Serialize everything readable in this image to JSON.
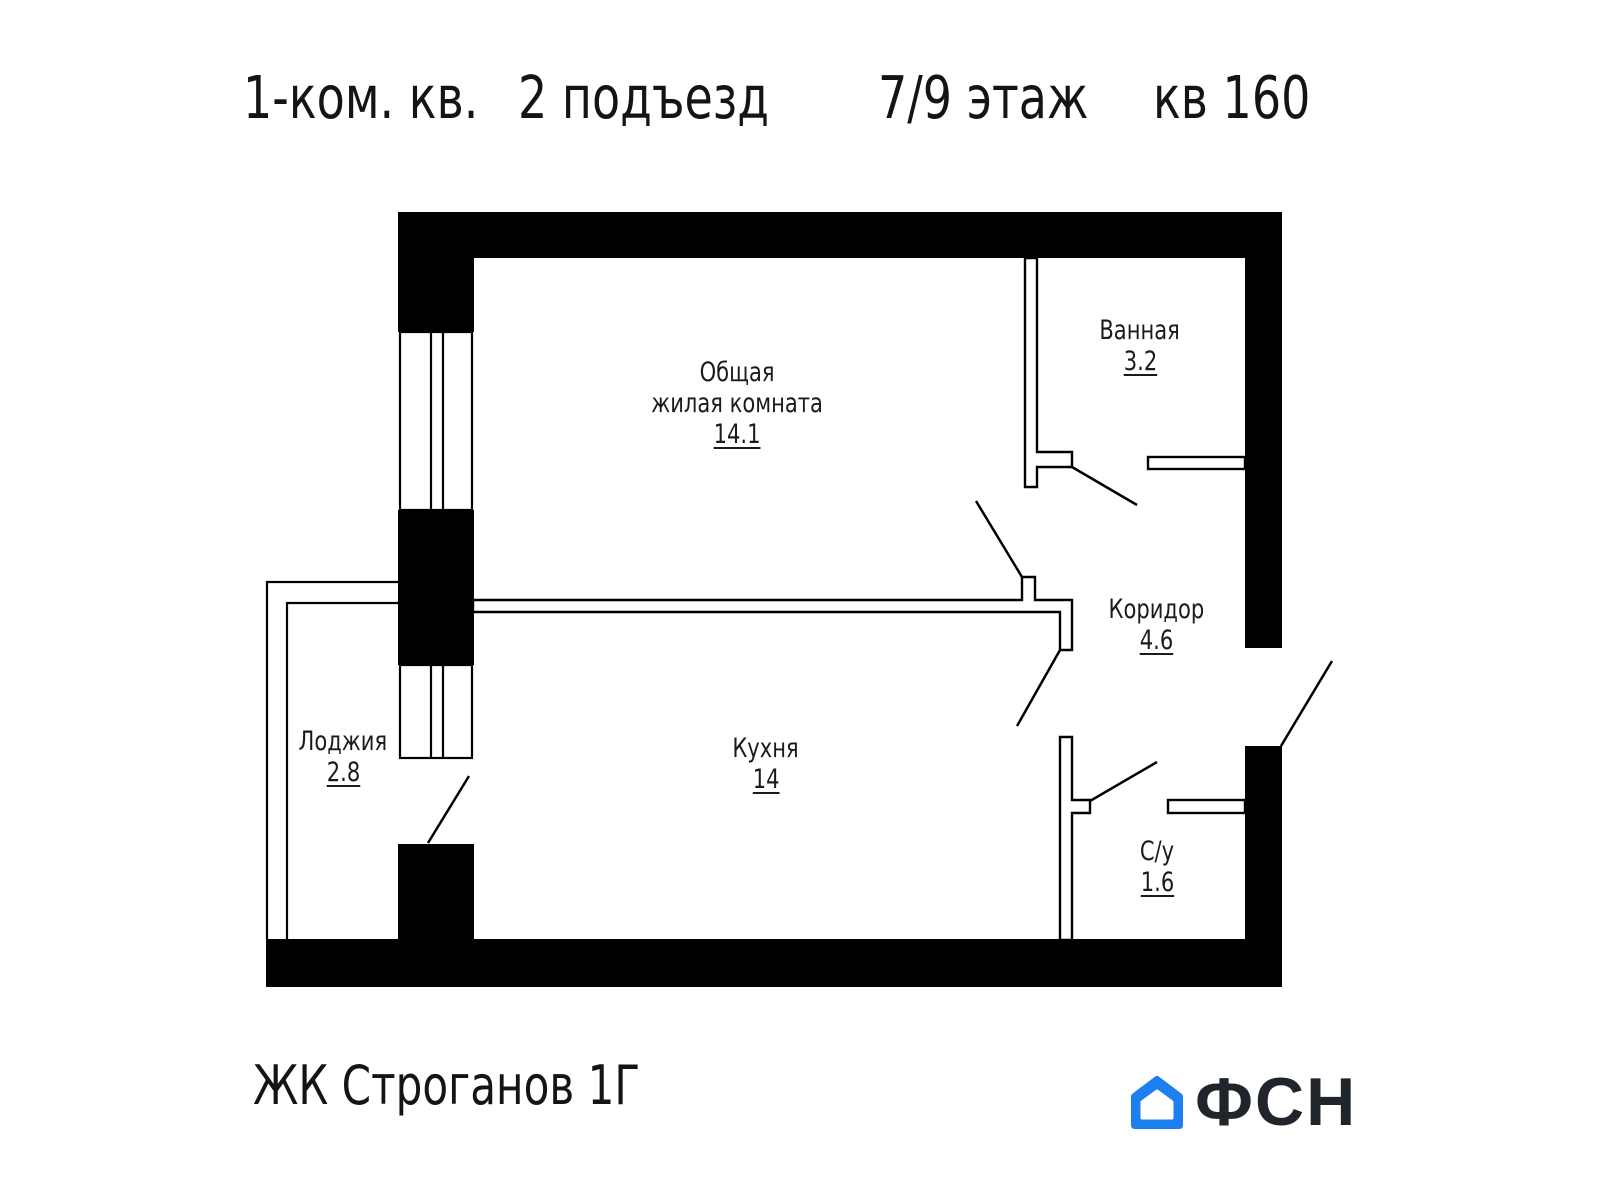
{
  "title": {
    "rooms_count": "1-ком. кв.",
    "entrance": "2 подъезд",
    "floor": "7/9 этаж",
    "apartment": "кв 160"
  },
  "rooms": [
    {
      "id": "living",
      "name": "Общая",
      "name2": "жилая комната",
      "area": "14.1"
    },
    {
      "id": "bathroom",
      "name": "Ванная",
      "area": "3.2"
    },
    {
      "id": "corridor",
      "name": "Коридор",
      "area": "4.6"
    },
    {
      "id": "kitchen",
      "name": "Кухня",
      "area": "14"
    },
    {
      "id": "loggia",
      "name": "Лоджия",
      "area": "2.8"
    },
    {
      "id": "toilet",
      "name": "С/у",
      "area": "1.6"
    }
  ],
  "footer": {
    "complex": "ЖК Строганов 1Г",
    "brand": "ФСН"
  },
  "icons": {
    "logo_house": "house-icon"
  },
  "colors": {
    "walls": "#000000",
    "text": "#1b1b1b",
    "brand_blue": "#1e80f0",
    "brand_dark": "#20242b",
    "background": "#ffffff"
  }
}
